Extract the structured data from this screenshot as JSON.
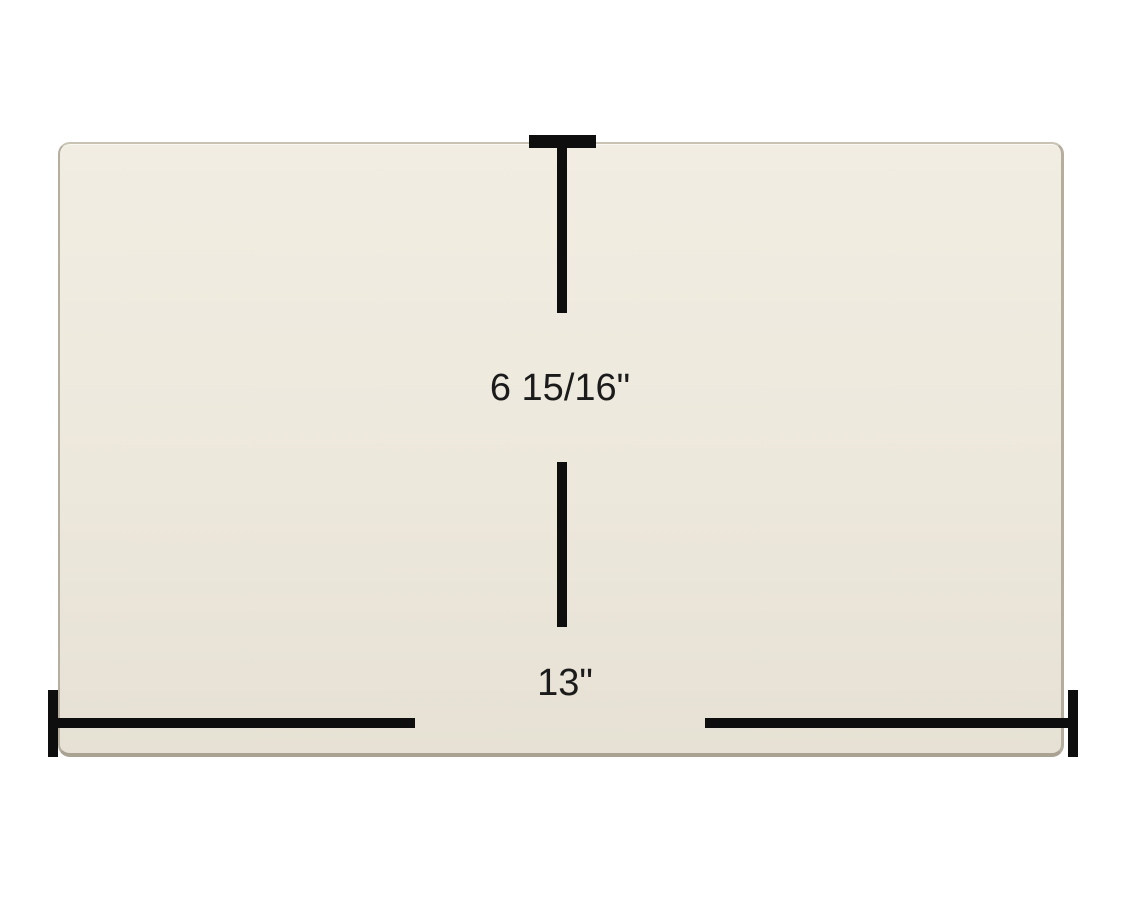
{
  "meta": {
    "title": "Rectangular glass panel dimension diagram"
  },
  "theme": {
    "background": "#ffffff",
    "panel_fill_top": "#f1ede2",
    "panel_fill_mid": "#ede8dc",
    "panel_fill_bottom": "#e6e1d4",
    "panel_edge": "#b5ae9f",
    "panel_edge_light": "#c9c3b4",
    "dimension_line": "#0e0e0e",
    "dimension_text": "#1b1b1b"
  },
  "diagram": {
    "subject": "rectangular glass panel, cream colored, rounded corners",
    "dimensions": {
      "height": {
        "label": "6 15/16\""
      },
      "width": {
        "label": "13\""
      }
    }
  }
}
